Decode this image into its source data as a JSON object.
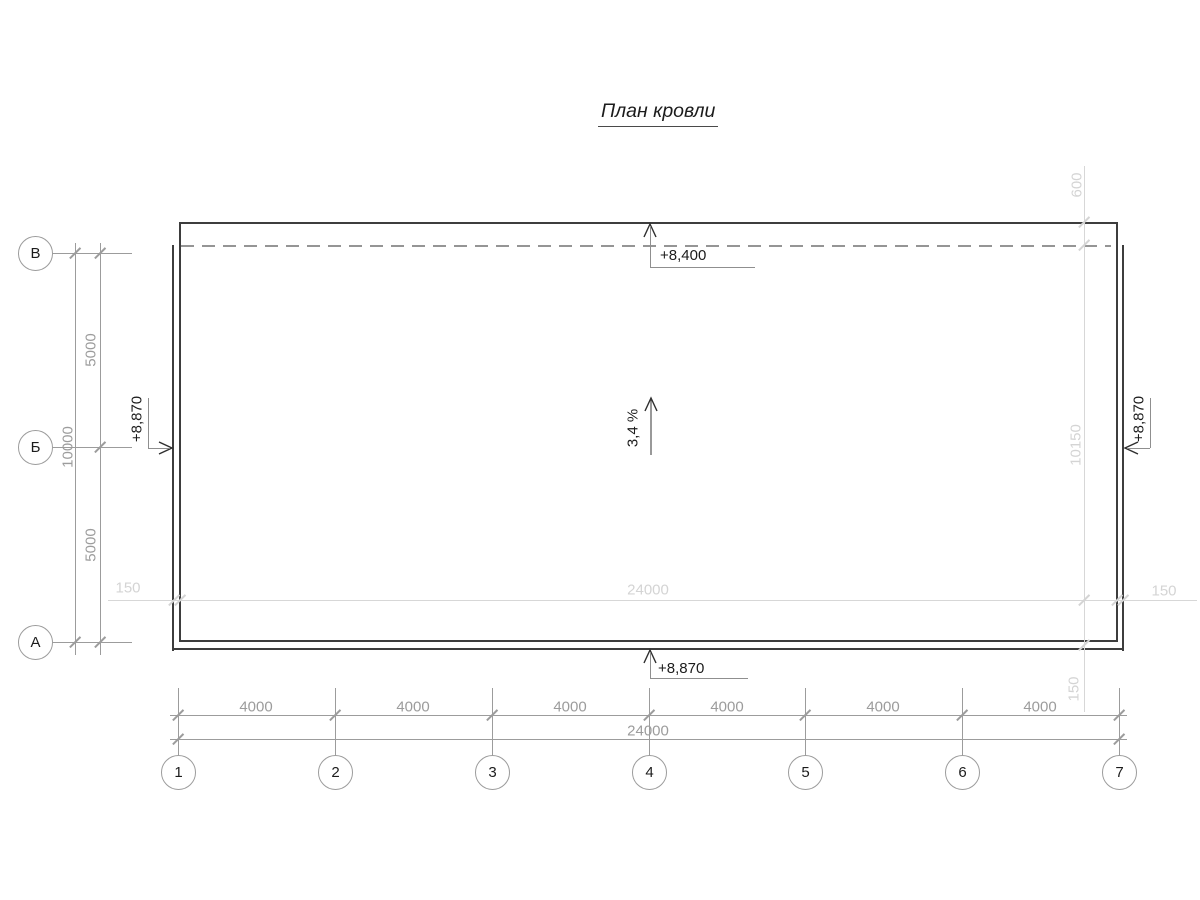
{
  "title": "План кровли",
  "row_axes": [
    {
      "label": "В"
    },
    {
      "label": "Б"
    },
    {
      "label": "А"
    }
  ],
  "column_axes": [
    {
      "label": "1"
    },
    {
      "label": "2"
    },
    {
      "label": "3"
    },
    {
      "label": "4"
    },
    {
      "label": "5"
    },
    {
      "label": "6"
    },
    {
      "label": "7"
    }
  ],
  "dimensions": {
    "left_overall": "10000",
    "left_segments": [
      "5000",
      "5000"
    ],
    "bottom_overall": "24000",
    "bottom_segments": [
      "4000",
      "4000",
      "4000",
      "4000",
      "4000",
      "4000"
    ],
    "offset_horizontal": {
      "left": "150",
      "center": "24000",
      "right": "150"
    },
    "offset_vertical": {
      "top": "600",
      "middle": "10150",
      "bottom": "150"
    }
  },
  "elevations": {
    "top": "+8,400",
    "bottom": "+8,870",
    "left": "+8,870",
    "right": "+8,870"
  },
  "slope": {
    "label": "3,4 %"
  },
  "colors": {
    "outline_dark": "#3d3d3d",
    "dim_medium": "#9c9c9c",
    "dim_light": "#d4d4d4",
    "text_black": "#1c1c1c"
  }
}
